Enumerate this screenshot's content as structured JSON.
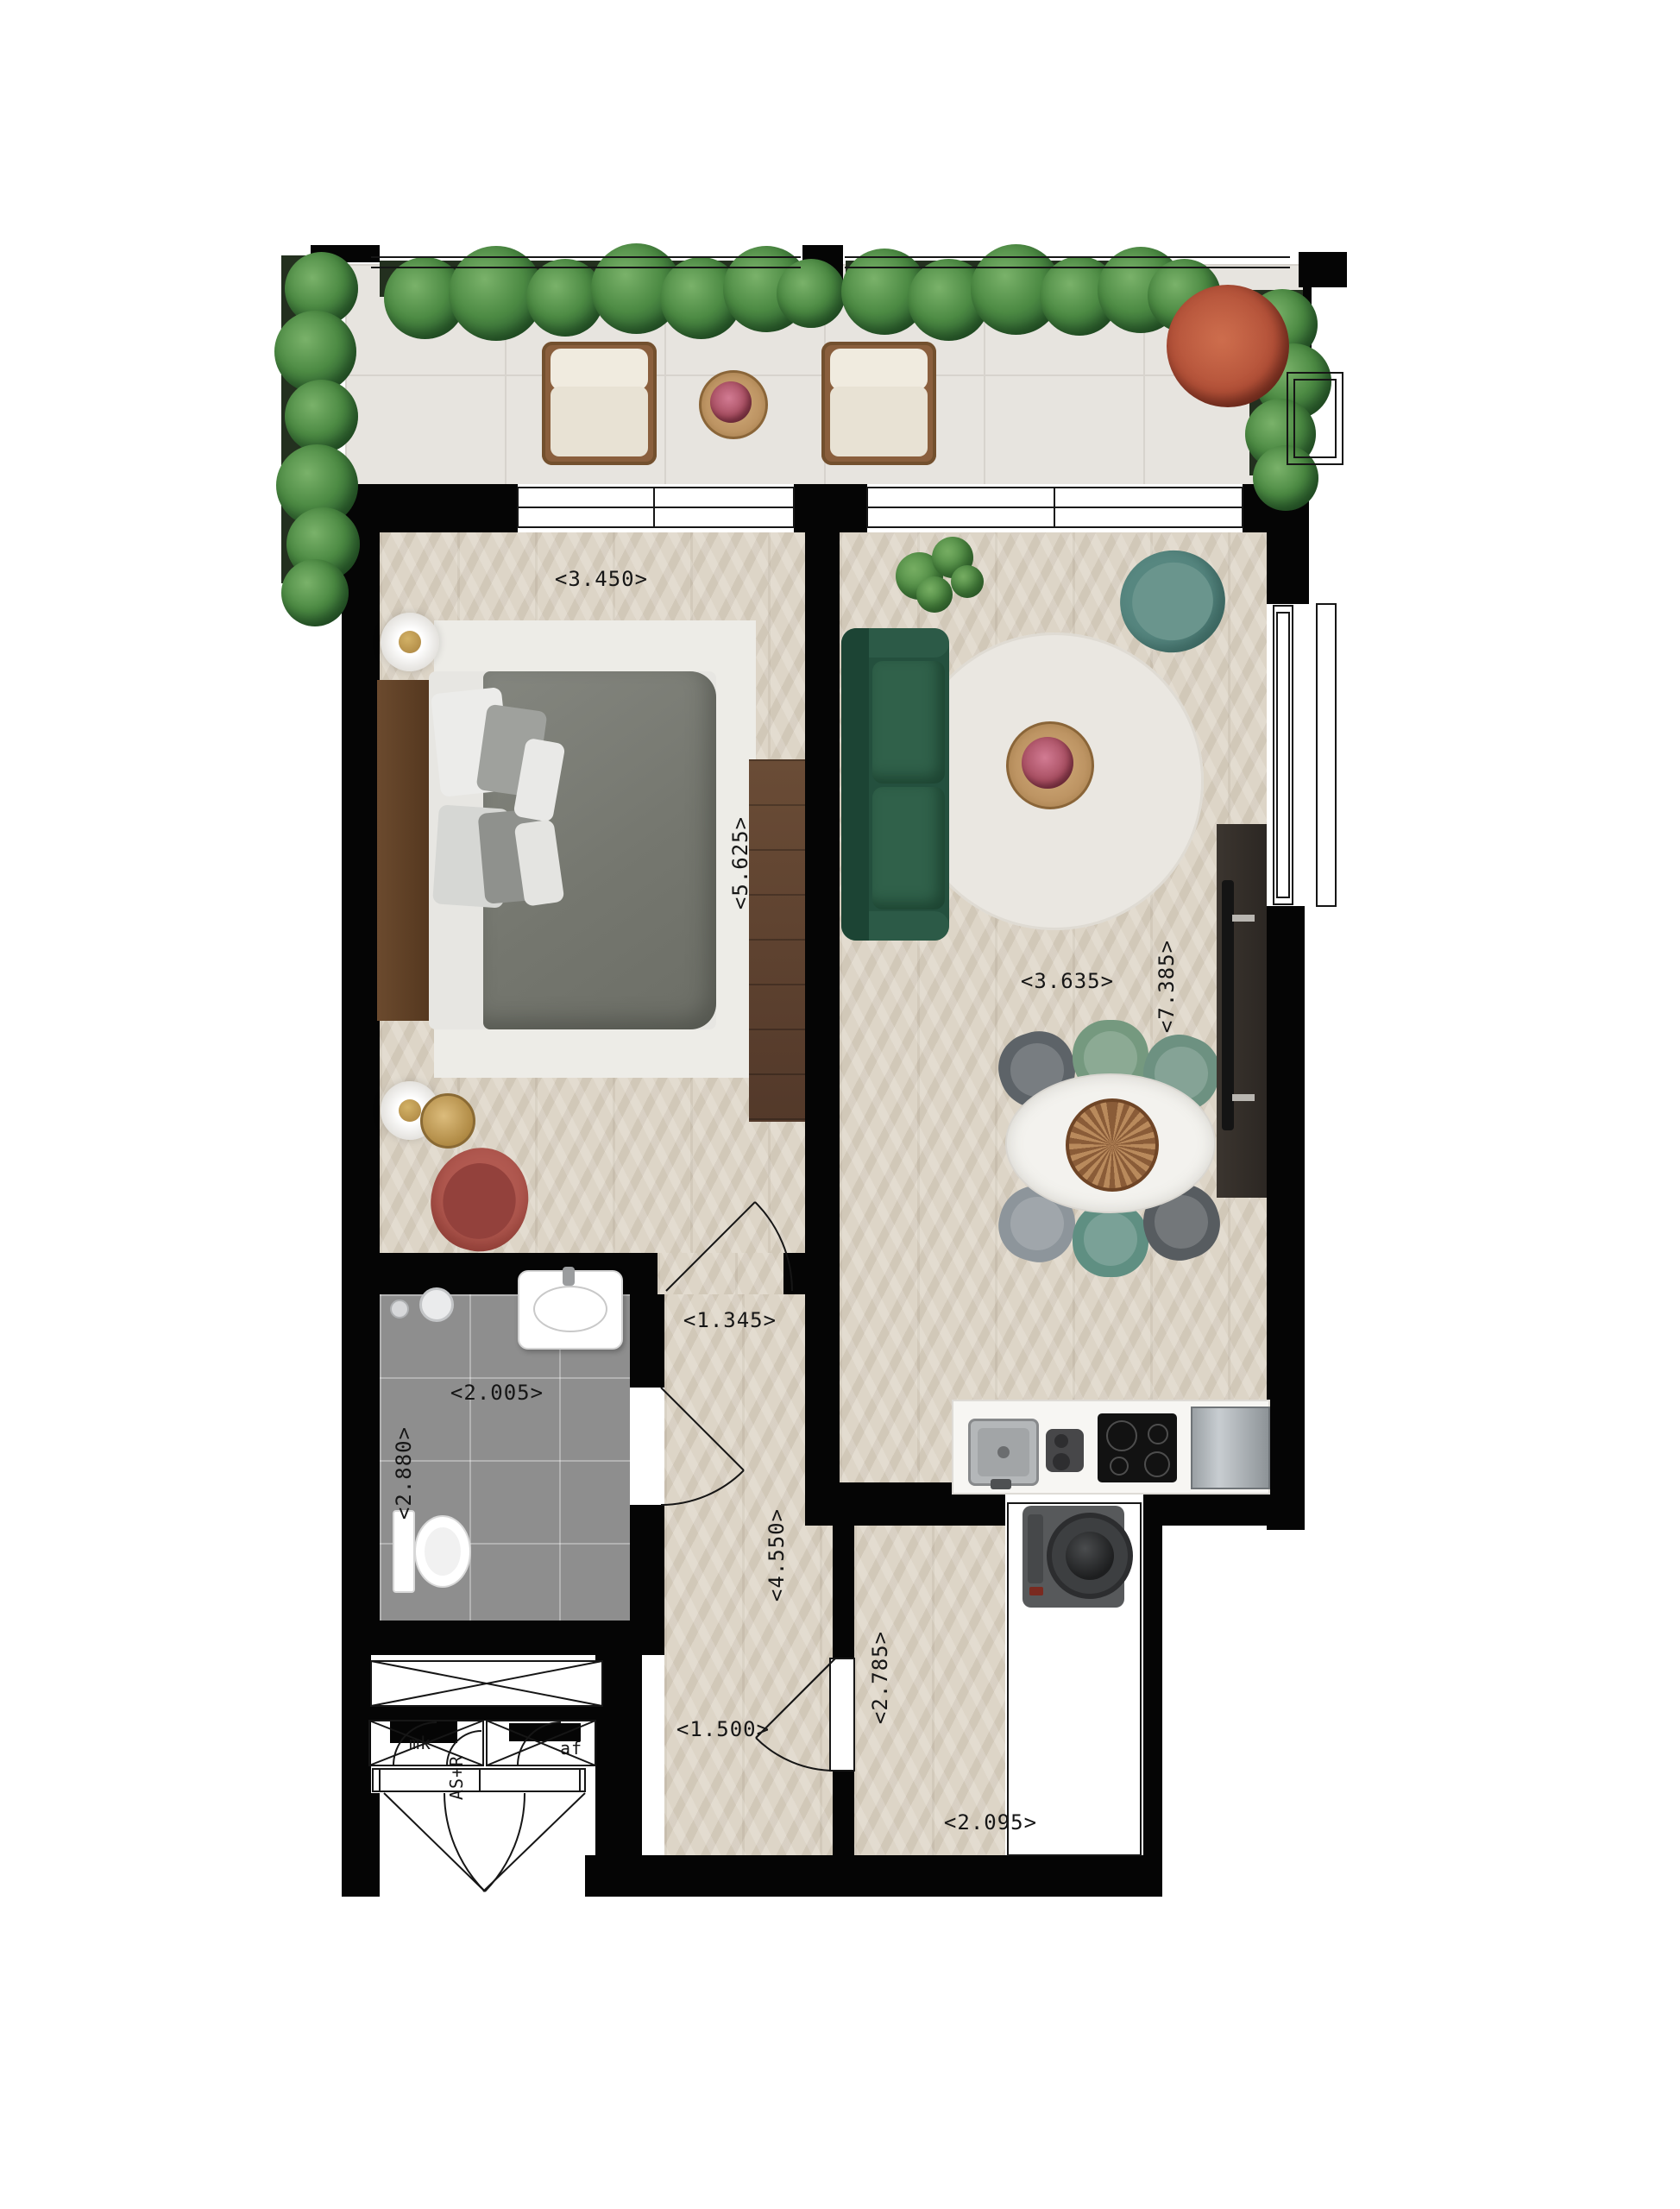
{
  "floorplan": {
    "type": "apartment-top-view-floor-plan",
    "dimension_labels": [
      {
        "id": "bedroom-width",
        "text": "<3.450>",
        "orientation": "horizontal"
      },
      {
        "id": "bedroom-depth",
        "text": "<5.625>",
        "orientation": "vertical"
      },
      {
        "id": "living-width",
        "text": "<3.635>",
        "orientation": "horizontal"
      },
      {
        "id": "living-depth",
        "text": "<7.385>",
        "orientation": "vertical"
      },
      {
        "id": "bathroom-width",
        "text": "<2.005>",
        "orientation": "horizontal"
      },
      {
        "id": "bathroom-depth",
        "text": "<2.880>",
        "orientation": "vertical"
      },
      {
        "id": "hallway-width",
        "text": "<1.345>",
        "orientation": "horizontal"
      },
      {
        "id": "hallway-depth",
        "text": "<4.550>",
        "orientation": "vertical"
      },
      {
        "id": "entry-width",
        "text": "<1.500>",
        "orientation": "horizontal"
      },
      {
        "id": "utility-depth",
        "text": "<2.785>",
        "orientation": "vertical"
      },
      {
        "id": "utility-width",
        "text": "<2.095>",
        "orientation": "horizontal"
      }
    ],
    "technical_labels": [
      {
        "id": "meter-closet",
        "text": "mk"
      },
      {
        "id": "shaft",
        "text": "AS+R",
        "orientation": "vertical"
      },
      {
        "id": "drain",
        "text": "af"
      }
    ],
    "rooms": [
      {
        "name": "terrace",
        "floor": "stone-tile",
        "features": [
          "planter-hedges",
          "lounge-chair",
          "lounge-chair",
          "wood-slice-table",
          "flowering-shrub"
        ]
      },
      {
        "name": "bedroom",
        "floor": "chevron-wood",
        "features": [
          "double-bed",
          "headboard",
          "area-rug",
          "bedside-lamp",
          "bedside-lamp",
          "side-table",
          "accent-armchair",
          "wardrobe"
        ]
      },
      {
        "name": "living-room",
        "floor": "chevron-wood",
        "features": [
          "green-chesterfield-sofa",
          "round-rug",
          "coffee-table-flowers",
          "teal-armchair",
          "plant",
          "dining-table-oval",
          "six-dining-chairs",
          "tv-cabinet"
        ]
      },
      {
        "name": "kitchen",
        "floor": "chevron-wood",
        "features": [
          "countertop",
          "sink",
          "coffee-machine",
          "induction-hob",
          "steel-appliance"
        ]
      },
      {
        "name": "bathroom",
        "floor": "grey-tile",
        "features": [
          "walk-in-shower",
          "washbasin",
          "wall-hung-toilet"
        ]
      },
      {
        "name": "hallway",
        "floor": "chevron-wood",
        "features": [
          "interior-doors"
        ]
      },
      {
        "name": "utility-area",
        "floor": "chevron-wood",
        "features": [
          "washing-machine-closet"
        ]
      },
      {
        "name": "entry",
        "floor": "none",
        "features": [
          "front-door",
          "technical-closets"
        ]
      }
    ],
    "colors": {
      "wall": "#050505",
      "wood_floor": "#ddd5c7",
      "terrace_tile": "#e7e4df",
      "bathroom_tile": "#8e8e8e",
      "sofa_green": "#24503e",
      "teal_chair": "#578780",
      "red_chair": "#b15950",
      "hedge_green": "#4c8a43",
      "flower_red": "#b04e36",
      "brass": "#a9823e",
      "wood_furniture": "#6a4c36"
    }
  }
}
